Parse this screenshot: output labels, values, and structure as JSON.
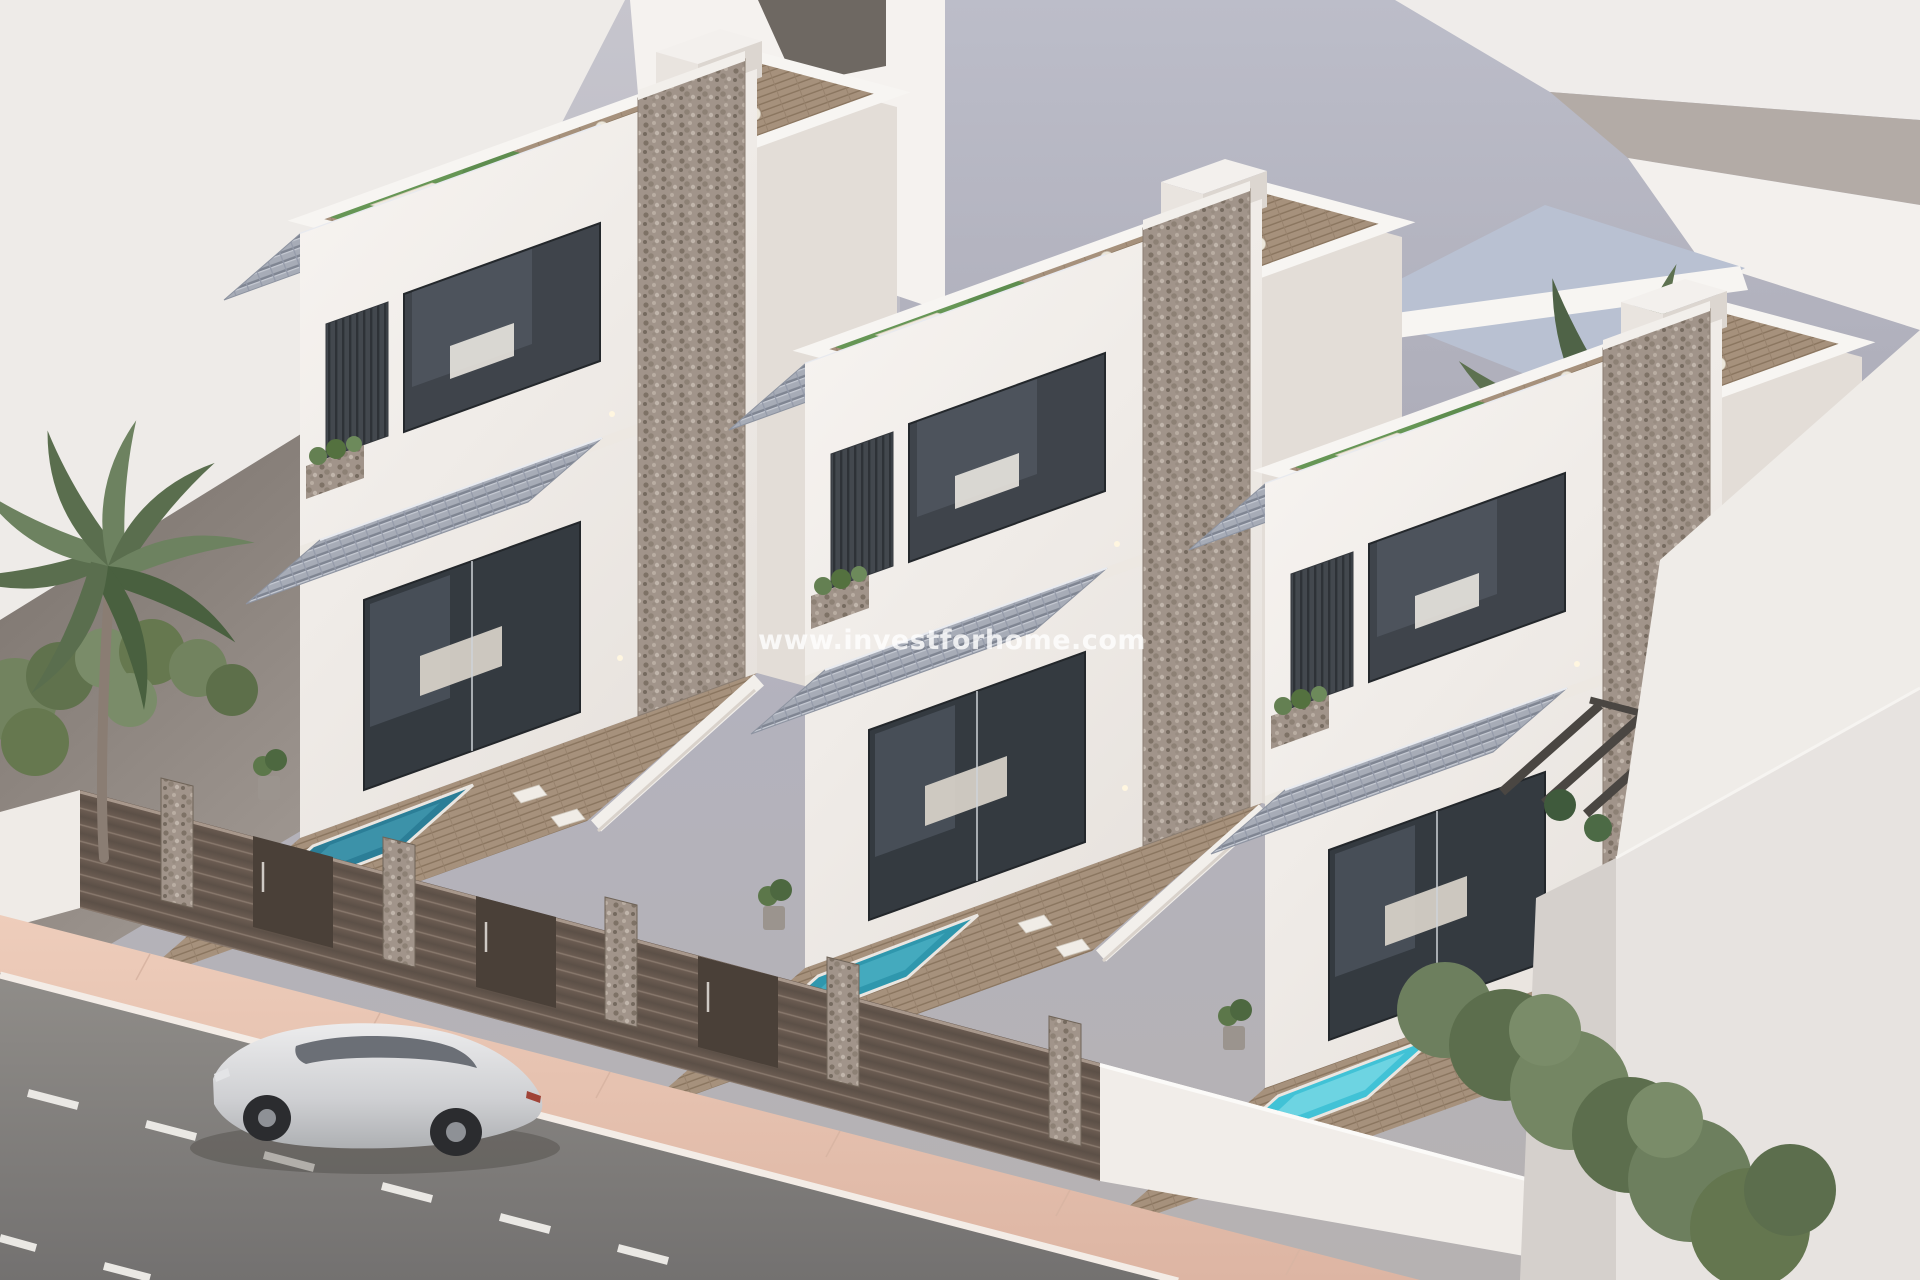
{
  "watermark": {
    "text": "www.investforhome.com"
  },
  "scene": {
    "type": "architectural-render",
    "elements": [
      "three modern two-storey villas in a row",
      "rooftop terraces with artificial grass, sun loungers and dining sets",
      "grey tiled roof slopes and awnings",
      "stone-clad accent columns and fence pillars",
      "dark slatted privacy fences with gates",
      "private plunge pools in front yards with wooden decks and armchairs",
      "palm trees left and right",
      "green hedge at lower right",
      "pink sidewalk and asphalt street with dashed lane markings",
      "silver SUV parked on the street",
      "abstract white neighbouring buildings in the background"
    ],
    "villas": [
      {
        "id": "villa-1",
        "pool_color": "#2b7e97"
      },
      {
        "id": "villa-2",
        "pool_color": "#2f97ad"
      },
      {
        "id": "villa-3",
        "pool_color": "#41c2d6"
      }
    ],
    "palette": {
      "background_wall": "#b0b1bd",
      "light_building": "#efecea",
      "shadow_wall": "#7b736d",
      "villa_white": "#f6f3f0",
      "roof_tiles": "#a7acb7",
      "stone": "#a1948a",
      "wood_deck": "#a6917c",
      "grass": "#669655",
      "fence_slats": "#5c5047",
      "sidewalk": "#e9c6b4",
      "road": "#8a8783",
      "car": "#d9dadc",
      "palm": "#5a6e4e",
      "hedge": "#6d7f5e",
      "watermark": "#ffffff"
    }
  }
}
